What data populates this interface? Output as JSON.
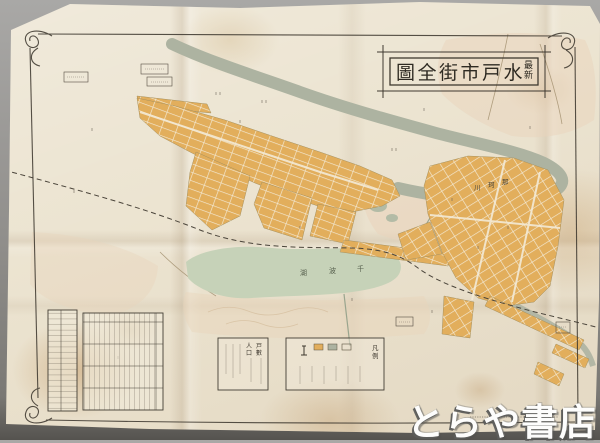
{
  "map": {
    "title": {
      "prefix": "最新",
      "prefix_chars": [
        "最",
        "新"
      ],
      "main": "水戸市街全圖",
      "display": "圖全街市戸水"
    },
    "labels": {
      "river": "那珂川",
      "river_display": [
        "川",
        "珂",
        "那"
      ],
      "lake": "千波湖",
      "lake_display": [
        "湖",
        "波",
        "千"
      ]
    },
    "legend": {
      "title": "凡例",
      "chars": [
        "凡",
        "例"
      ]
    },
    "stats": {
      "items": [
        "戸數",
        "人口"
      ],
      "chars": [
        "戸",
        "數",
        "人",
        "口"
      ]
    },
    "colors": {
      "paper": "#ece4d1",
      "ink": "#3f3930",
      "block_yellow": "#e2ae5c",
      "street_cream": "#f3ead6",
      "river_green": "#adb3a1",
      "lake_green": "#c6d2b8",
      "terrain_pink": "#e9d4bb",
      "stain_brown": "#c49a66"
    }
  },
  "watermark": {
    "text": "とらや書店"
  }
}
